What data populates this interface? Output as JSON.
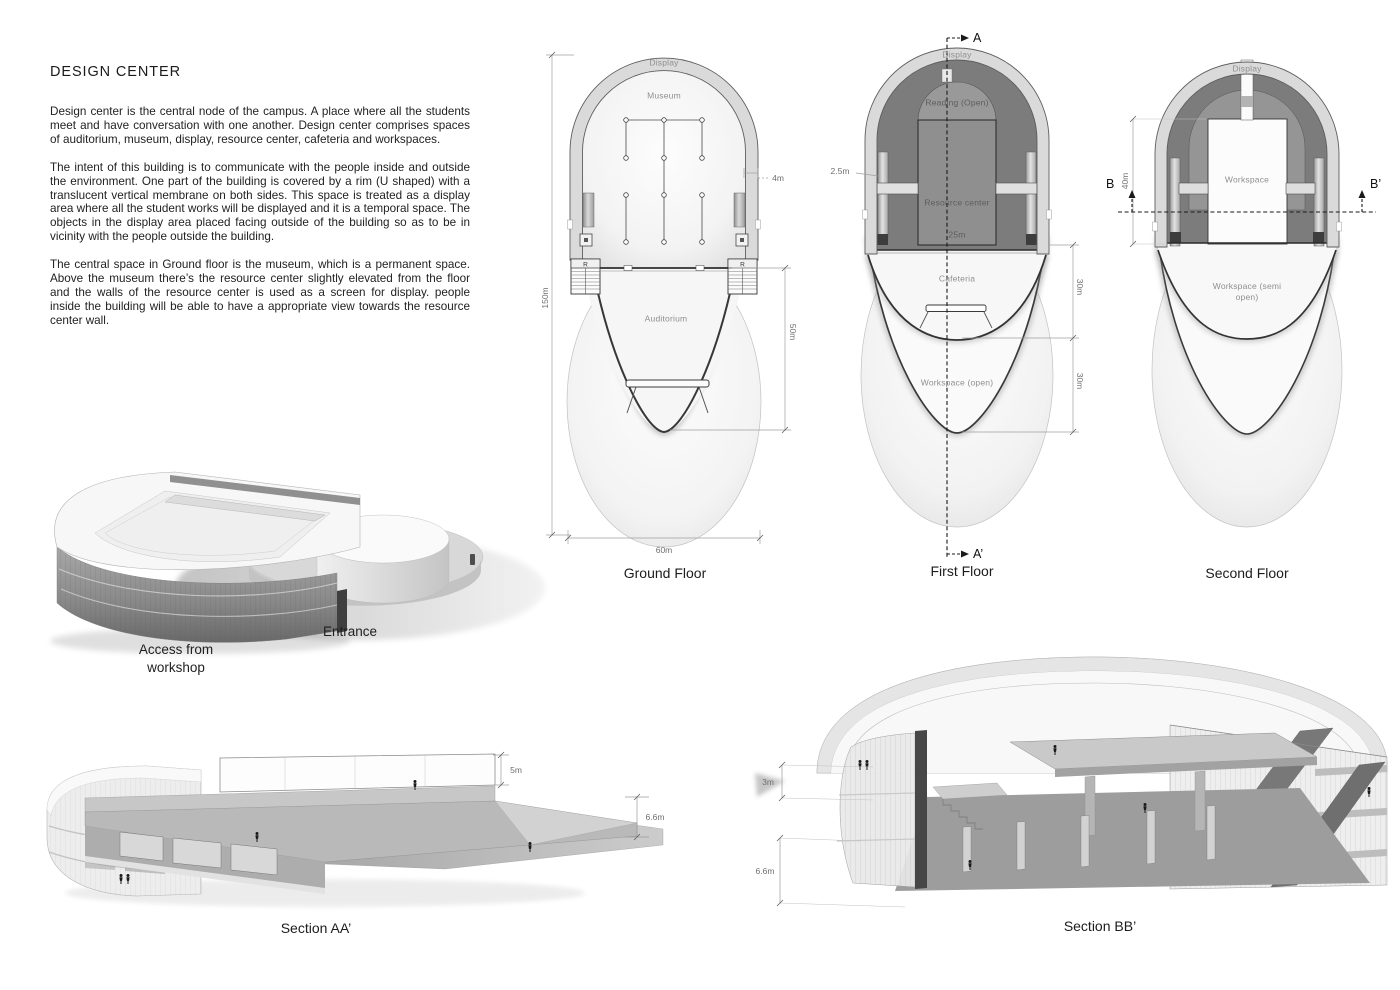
{
  "colors": {
    "background": "#ffffff",
    "rim_fill": "#dadada",
    "dark_ring": "#7c7c7c",
    "ink": "#1a1a1a",
    "dim_text": "#6e6e6e",
    "plan_label": "#8f8f8f"
  },
  "text_panel": {
    "title": "DESIGN CENTER",
    "paragraphs": [
      "Design center is the central node of the campus. A place where all the students meet and have conversation with one another. Design center comprises spaces of auditorium, museum, display, resource center, cafeteria and workspaces.",
      "The intent of this building is to communicate with the people inside and outside the environment.  One part of the building is covered by a rim (U shaped) with a translucent vertical membrane on both sides. This space is treated as a display area where all the student works will be displayed and it is a temporal space. The objects in the display area placed facing outside of the building so as to be in vicinity with the people outside the building.",
      "The central space in Ground floor is the museum, which is a permanent space. Above the museum there’s the resource center slightly elevated from the floor and the walls of the resource center is used as a screen for display. people inside the building will be able to have a appropriate view towards the resource center wall."
    ]
  },
  "plans": {
    "ground": {
      "caption": "Ground Floor",
      "labels": {
        "display": "Display",
        "museum": "Museum",
        "auditorium": "Auditorium"
      },
      "stairs": {
        "left": "R",
        "right": "R"
      },
      "dims": {
        "height": "150m",
        "rim": "4m",
        "auditorium_depth": "50m",
        "width": "60m"
      }
    },
    "first": {
      "caption": "First Floor",
      "labels": {
        "display": "Display",
        "reading": "Reading (Open)",
        "resource": "Resource center",
        "resource_width": "25m",
        "cafeteria": "Cafeteria",
        "workspace": "Workspace (open)"
      },
      "dims": {
        "rim_offset": "2.5m",
        "cafeteria_depth": "30m",
        "workspace_depth": "30m"
      },
      "section_line": {
        "start": "A",
        "end": "A’"
      }
    },
    "second": {
      "caption": "Second Floor",
      "labels": {
        "display": "Display",
        "workspace": "Workspace",
        "workspace_semi": "Workspace (semi open)"
      },
      "dims": {
        "workspace_height": "40m"
      },
      "section_line": {
        "start": "B",
        "end": "B’"
      }
    }
  },
  "axonometric": {
    "entrance_label": "Entrance",
    "access_label": "Access from workshop"
  },
  "sections": {
    "aa": {
      "caption": "Section AA’",
      "dims": {
        "parapet": "5m",
        "ground_height": "6.6m"
      }
    },
    "bb": {
      "caption": "Section BB’",
      "dims": {
        "floor_height": "3m",
        "ground_height": "6.6m"
      }
    }
  }
}
